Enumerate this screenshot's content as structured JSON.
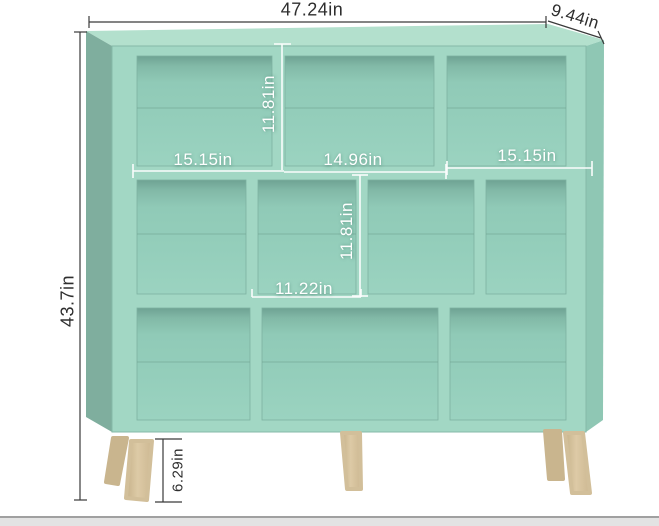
{
  "scene": {
    "description": "Product dimension diagram of a mint green 10-cube staggered bookshelf with wooden splayed legs",
    "background_color": "#ffffff",
    "footer_strip_color": "#e3e3e3"
  },
  "product": {
    "name": "cube-storage-bookshelf",
    "colors": {
      "front_frame": "#a2d7c4",
      "cubby_interior": "#92ccb9",
      "left_side_panel": "#7fae9e",
      "top_surface": "#b3e0cd",
      "right_side_panel": "#8fc7b4",
      "legs_wood": "#d7c4a0",
      "dimension_line_dark": "#3a3a3a",
      "dimension_line_light": "#ffffff"
    },
    "cubby_rows": [
      3,
      4,
      3
    ],
    "leg_count_visible": 5
  },
  "annotations": {
    "overall_width": "47.24in",
    "depth": "9.44in",
    "overall_height": "43.7in",
    "top_cube_height": "11.81in",
    "top_left_cube_width": "15.15in",
    "top_middle_cube_width": "14.96in",
    "top_right_cube_width": "15.15in",
    "middle_cube_height": "11.81in",
    "middle_cube_width": "11.22in",
    "leg_height": "6.29in"
  }
}
